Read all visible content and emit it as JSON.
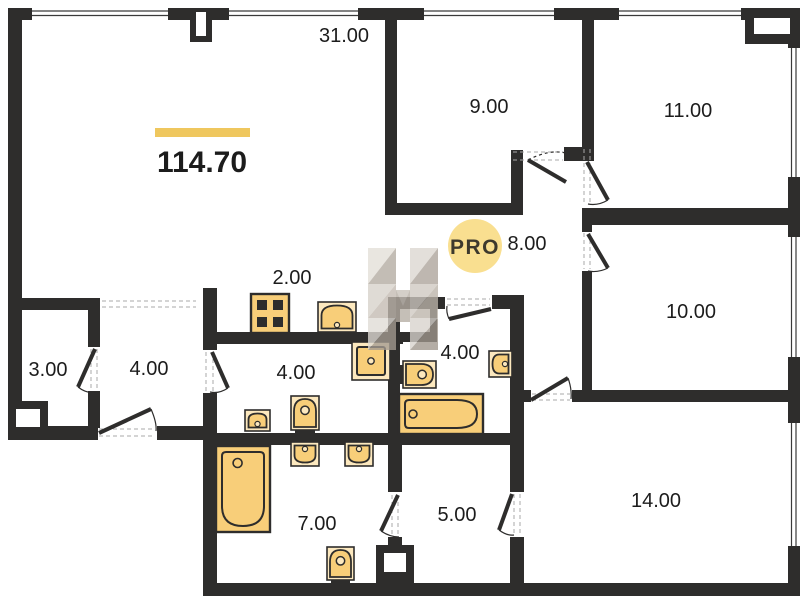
{
  "plan": {
    "total_area": {
      "value": "114.70"
    },
    "watermark": {
      "badge": "PRO"
    },
    "colors": {
      "wall": "#2e2d2c",
      "fixture": "#F8CE79",
      "fixture_light": "#FCE8BE",
      "accent_bar": "#EFC75E",
      "label": "#1c1c1c",
      "watermark_circle": "#F8DC87",
      "watermark_text": "#C7A351"
    },
    "rooms": [
      {
        "id": "living-room",
        "label": "31.00",
        "x": 344,
        "y": 42
      },
      {
        "id": "room-9",
        "label": "9.00",
        "x": 489,
        "y": 113
      },
      {
        "id": "room-11",
        "label": "11.00",
        "x": 688,
        "y": 117
      },
      {
        "id": "hallway-8",
        "label": "8.00",
        "x": 527,
        "y": 250
      },
      {
        "id": "room-10",
        "label": "10.00",
        "x": 691,
        "y": 318
      },
      {
        "id": "kitchen-niche",
        "label": "2.00",
        "x": 292,
        "y": 284
      },
      {
        "id": "storage-3",
        "label": "3.00",
        "x": 48,
        "y": 376
      },
      {
        "id": "entry-hall-4",
        "label": "4.00",
        "x": 149,
        "y": 375
      },
      {
        "id": "bathroom-4a",
        "label": "4.00",
        "x": 296,
        "y": 379
      },
      {
        "id": "bathroom-4b",
        "label": "4.00",
        "x": 460,
        "y": 359
      },
      {
        "id": "room-14",
        "label": "14.00",
        "x": 656,
        "y": 507
      },
      {
        "id": "bathroom-7",
        "label": "7.00",
        "x": 317,
        "y": 530
      },
      {
        "id": "room-5",
        "label": "5.00",
        "x": 457,
        "y": 521
      }
    ],
    "fixtures": [
      {
        "id": "stove",
        "type": "stove",
        "dir": "up",
        "x": 251,
        "y": 294,
        "w": 38,
        "h": 39
      },
      {
        "id": "kitchen-sink",
        "type": "sink",
        "dir": "up",
        "x": 318,
        "y": 302,
        "w": 38,
        "h": 30
      },
      {
        "id": "shower",
        "type": "shower",
        "dir": "up",
        "x": 352,
        "y": 342,
        "w": 38,
        "h": 38
      },
      {
        "id": "bath-a-toilet",
        "type": "toilet",
        "dir": "up",
        "x": 291,
        "y": 396,
        "w": 28,
        "h": 34
      },
      {
        "id": "bath-a-sink",
        "type": "sink",
        "dir": "up",
        "x": 245,
        "y": 410,
        "w": 25,
        "h": 21
      },
      {
        "id": "bath-b-toilet",
        "type": "toilet",
        "dir": "right",
        "x": 403,
        "y": 361,
        "w": 33,
        "h": 27
      },
      {
        "id": "bath-b-sink",
        "type": "sink",
        "dir": "left",
        "x": 489,
        "y": 351,
        "w": 23,
        "h": 26
      },
      {
        "id": "bath-b-tub",
        "type": "tub-h",
        "dir": "up",
        "x": 399,
        "y": 394,
        "w": 84,
        "h": 40
      },
      {
        "id": "bath-c-tub",
        "type": "tub-v",
        "dir": "up",
        "x": 216,
        "y": 446,
        "w": 54,
        "h": 86
      },
      {
        "id": "bath-c-sink-1",
        "type": "sink",
        "dir": "down",
        "x": 291,
        "y": 442,
        "w": 28,
        "h": 24
      },
      {
        "id": "bath-c-sink-2",
        "type": "sink",
        "dir": "down",
        "x": 345,
        "y": 442,
        "w": 28,
        "h": 24
      },
      {
        "id": "bath-c-toilet",
        "type": "toilet",
        "dir": "up",
        "x": 327,
        "y": 547,
        "w": 27,
        "h": 33
      }
    ]
  }
}
